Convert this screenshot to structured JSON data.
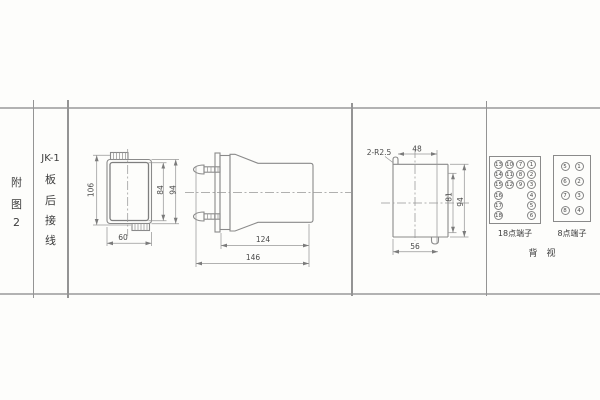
{
  "sheet": {
    "row_label": [
      "附",
      "图",
      "2"
    ],
    "figure_title": "JK-1",
    "figure_subtitle_chars": [
      "板",
      "后",
      "接",
      "线"
    ]
  },
  "front_view": {
    "dim_total_height": "106",
    "dim_inner_height": "84",
    "dim_outer_height": "94",
    "dim_width": "60"
  },
  "side_view": {
    "dim_body_length": "124",
    "dim_total_length": "146"
  },
  "cutout_view": {
    "note_radius": "2-R2.5",
    "dim_hook_spacing": "48",
    "dim_inner_height": "81",
    "dim_total_height": "94",
    "dim_width": "56"
  },
  "terminals": {
    "t18": {
      "label": "18点端子",
      "values": [
        "13",
        "10",
        "7",
        "1",
        "14",
        "11",
        "8",
        "2",
        "15",
        "12",
        "9",
        "3",
        "16",
        "4",
        "17",
        "5",
        "18",
        "6"
      ]
    },
    "t8": {
      "label": "8点端子",
      "values": [
        "5",
        "1",
        "6",
        "2",
        "7",
        "3",
        "8",
        "4"
      ]
    },
    "rear_view_label": "背　视"
  }
}
